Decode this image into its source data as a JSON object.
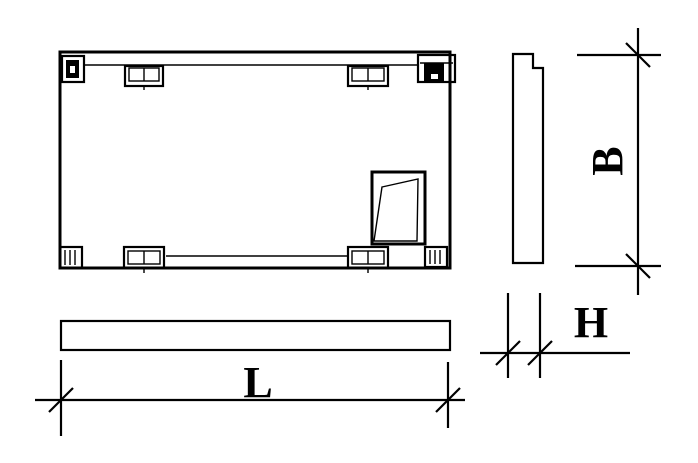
{
  "drawing": {
    "type": "engineering-drawing",
    "description": "Three orthographic views of a precast rectangular panel with corner lifting anchors, edge embed plates and a skewed opening detail, dimensioned L x B x H",
    "dimension_labels": {
      "length": "L",
      "width": "B",
      "thickness": "H"
    },
    "colors": {
      "line": "#000000",
      "background": "#ffffff"
    }
  }
}
